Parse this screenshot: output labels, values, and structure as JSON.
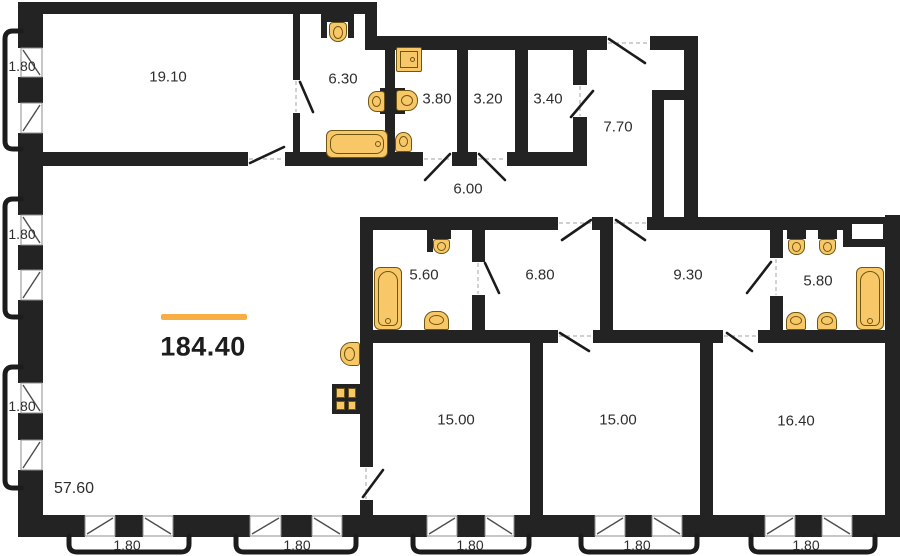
{
  "plan": {
    "title_area": "184.40",
    "left_section_area": "57.60",
    "accent_color": "#F6AE45",
    "wall_color": "#232323",
    "fixture_fill": "#F8C868",
    "fixture_outline": "#6F5713"
  },
  "rooms": [
    {
      "name": "room-19-10",
      "area": "19.10"
    },
    {
      "name": "bathroom-6-30",
      "area": "6.30"
    },
    {
      "name": "bathroom-3-80",
      "area": "3.80"
    },
    {
      "name": "storage-3-20",
      "area": "3.20"
    },
    {
      "name": "storage-3-40",
      "area": "3.40"
    },
    {
      "name": "hall-7-70",
      "area": "7.70"
    },
    {
      "name": "corridor-6-00",
      "area": "6.00"
    },
    {
      "name": "bathroom-5-60",
      "area": "5.60"
    },
    {
      "name": "room-6-80",
      "area": "6.80"
    },
    {
      "name": "room-9-30",
      "area": "9.30"
    },
    {
      "name": "bathroom-5-80",
      "area": "5.80"
    },
    {
      "name": "room-15-00-left",
      "area": "15.00"
    },
    {
      "name": "room-15-00-right",
      "area": "15.00"
    },
    {
      "name": "room-16-40",
      "area": "16.40"
    }
  ],
  "window_labels": {
    "left": [
      "1.80",
      "1.80",
      "1.80"
    ],
    "bottom": [
      "1.80",
      "1.80",
      "1.80",
      "1.80",
      "1.80"
    ]
  }
}
